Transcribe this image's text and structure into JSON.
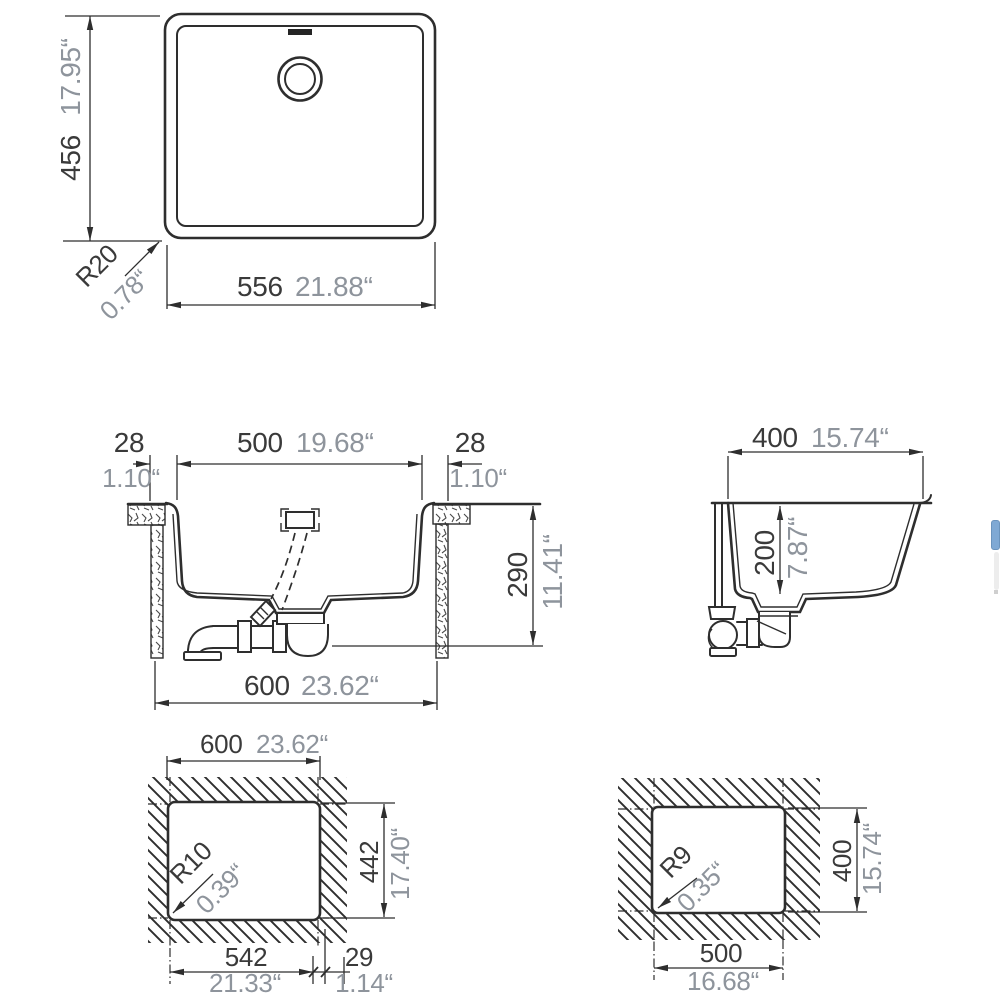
{
  "colors": {
    "line": "#2e2e2e",
    "mm_text": "#3a3a3a",
    "inch_text": "#8e949c",
    "scrollbar_thumb": "#7fa9d4",
    "scrollbar_track_thumb": "#ededed"
  },
  "plan_view": {
    "width_mm": "556",
    "width_in": "21.88“",
    "height_mm": "456",
    "height_in": "17.95“",
    "corner_radius_mm": "R20",
    "corner_radius_in": "0.78“"
  },
  "front_section": {
    "left_rim_mm": "28",
    "left_rim_in": "1.10“",
    "bowl_width_mm": "500",
    "bowl_width_in": "19.68“",
    "right_rim_mm": "28",
    "right_rim_in": "1.10“",
    "height_mm": "290",
    "height_in": "11.41“",
    "overall_width_mm": "600",
    "overall_width_in": "23.62“"
  },
  "side_section": {
    "width_mm": "400",
    "width_in": "15.74“",
    "bowl_depth_mm": "200",
    "bowl_depth_in": "7.87“"
  },
  "cutout_main": {
    "width_mm": "600",
    "width_in": "23.62“",
    "height_mm": "442",
    "height_in": "17.40“",
    "corner_radius_mm": "R10",
    "corner_radius_in": "0.39“",
    "lower_width_mm": "542",
    "lower_width_in": "21.33“",
    "edge_offset_mm": "29",
    "edge_offset_in": "1.14“"
  },
  "cutout_alt": {
    "width_mm": "500",
    "width_in": "16.68“",
    "height_mm": "400",
    "height_in": "15.74“",
    "corner_radius_mm": "R9",
    "corner_radius_in": "0.35“"
  }
}
